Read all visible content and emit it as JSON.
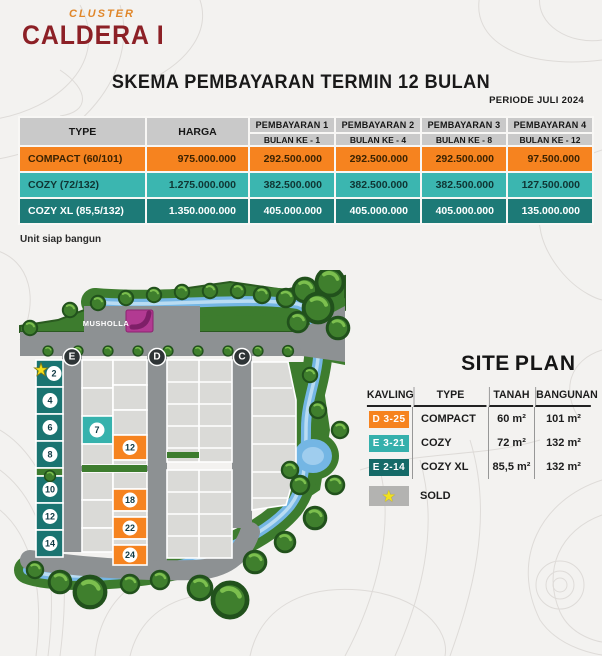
{
  "logo": {
    "cluster": "CLUSTER",
    "name": "CALDERA I"
  },
  "header": {
    "title": "SKEMA PEMBAYARAN TERMIN 12 BULAN",
    "period": "PERIODE JULI 2024"
  },
  "payment_table": {
    "col_headers": {
      "type": "TYPE",
      "harga": "HARGA"
    },
    "payment_headers": [
      {
        "title": "PEMBAYARAN 1",
        "sub": "BULAN KE - 1"
      },
      {
        "title": "PEMBAYARAN 2",
        "sub": "BULAN KE - 4"
      },
      {
        "title": "PEMBAYARAN 3",
        "sub": "BULAN KE - 8"
      },
      {
        "title": "PEMBAYARAN 4",
        "sub": "BULAN KE - 12"
      }
    ],
    "rows": [
      {
        "type": "COMPACT (60/101)",
        "harga": "975.000.000",
        "p1": "292.500.000",
        "p2": "292.500.000",
        "p3": "292.500.000",
        "p4": "97.500.000",
        "color": "#f6831f"
      },
      {
        "type": "COZY (72/132)",
        "harga": "1.275.000.000",
        "p1": "382.500.000",
        "p2": "382.500.000",
        "p3": "382.500.000",
        "p4": "127.500.000",
        "color": "#3bb6b0"
      },
      {
        "type": "COZY XL (85,5/132)",
        "harga": "1.350.000.000",
        "p1": "405.000.000",
        "p2": "405.000.000",
        "p3": "405.000.000",
        "p4": "135.000.000",
        "color": "#1d7a77"
      }
    ]
  },
  "note": "Unit siap bangun",
  "site_plan": {
    "title_light": "SITE",
    "title_bold": "PLAN",
    "legend": {
      "headers": [
        "KAVLING",
        "TYPE",
        "TANAH",
        "BANGUNAN"
      ],
      "rows": [
        {
          "kavling": "D 3-25",
          "type": "COMPACT",
          "tanah": "60 m²",
          "bangunan": "101 m²",
          "color": "#f6831f"
        },
        {
          "kavling": "E 3-21",
          "type": "COZY",
          "tanah": "72 m²",
          "bangunan": "132 m²",
          "color": "#35b0ac"
        },
        {
          "kavling": "E 2-14",
          "type": "COZY XL",
          "tanah": "85,5 m²",
          "bangunan": "132 m²",
          "color": "#156a68"
        }
      ],
      "sold_label": "SOLD"
    },
    "map": {
      "musholla_label": "MUSHOLLA",
      "road_labels": [
        "E",
        "D",
        "C"
      ],
      "left_lots": [
        "2",
        "4",
        "6",
        "8",
        "10",
        "12",
        "14"
      ],
      "available_lots": [
        {
          "number": "7",
          "color": "teal"
        },
        {
          "number": "12",
          "color": "orange"
        },
        {
          "number": "18",
          "color": "orange"
        },
        {
          "number": "22",
          "color": "orange"
        },
        {
          "number": "24",
          "color": "orange"
        }
      ],
      "sold_star_lot": "2"
    }
  },
  "colors": {
    "accent_orange": "#f6831f",
    "teal": "#36b2ad",
    "dark_teal": "#1a7471",
    "logo_red": "#8c2026",
    "logo_orange": "#e08629",
    "musholla_magenta": "#b23a92",
    "sold_star_yellow": "#f4e01c",
    "header_gray": "#c9c9c9",
    "sold_gray": "#b3b3b1",
    "road_gray": "#8d9193",
    "river_blue": "#74b6e4",
    "green": "#3d7c2e"
  }
}
